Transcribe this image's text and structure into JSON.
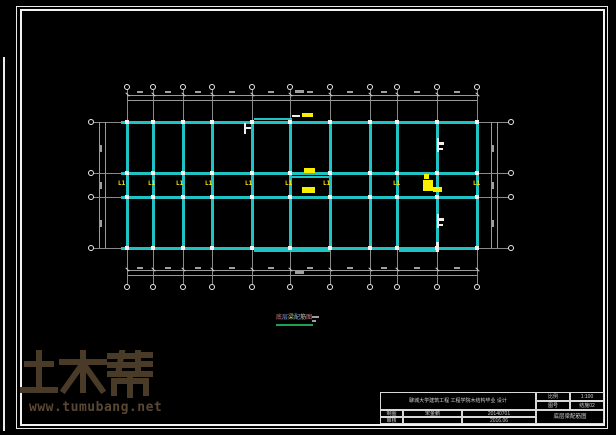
{
  "sheet": {
    "background": "#000000",
    "frame_color": "#f2f2f2"
  },
  "watermark": {
    "brand": "土木帮",
    "url": "www.tumubang.net",
    "logo_color": "#4a3a28",
    "url_color": "#5a4733"
  },
  "caption": {
    "chars": [
      {
        "ch": "底",
        "color": "#d08080"
      },
      {
        "ch": "层",
        "color": "#8098d8"
      },
      {
        "ch": "梁",
        "color": "#d0d080"
      },
      {
        "ch": "配",
        "color": "#80b8d8"
      },
      {
        "ch": "筋",
        "color": "#c8c8c8"
      },
      {
        "ch": "图",
        "color": "#d08080"
      }
    ],
    "underline_color": "#1ea050",
    "scale_marks": [
      {
        "x": 312,
        "y": 316,
        "w": 7,
        "h": 2
      },
      {
        "x": 312,
        "y": 320,
        "w": 4,
        "h": 2
      }
    ]
  },
  "title_block": {
    "project_title": "聊城大学建筑工程 工程学院木结构毕业 设计",
    "scale_label": "比例",
    "scale_value": "1:100",
    "sheet_no_label": "图号",
    "sheet_no_value": "结施02",
    "draw_label": "制图",
    "draw_name": "宋金鹏",
    "draw_no": "20140701",
    "check_label": "审核",
    "check_name": "",
    "check_date": "2016.06",
    "drawing_name": "底层梁配筋图"
  },
  "plan": {
    "beam_color": "#1fc3c3",
    "grid_color": "#8a8a8a",
    "tag_color": "#ffe800",
    "axes_x": [
      127,
      153,
      183,
      212,
      252,
      290,
      330,
      370,
      397,
      437,
      477
    ],
    "axes_y": [
      122,
      173,
      197,
      248
    ],
    "extent": {
      "x1": 121,
      "x2": 479,
      "y1": 121,
      "y2": 249
    },
    "grid": {
      "vy1": 90,
      "vy2": 284,
      "hx1": 94,
      "hx2": 508
    },
    "bubbles": {
      "top_y": 87,
      "bottom_y": 287,
      "left_x": 91,
      "right_x": 511
    },
    "dims": {
      "top": [
        95,
        100
      ],
      "bottom": [
        270,
        275
      ],
      "left": [
        99,
        105
      ],
      "right": [
        491,
        497
      ]
    },
    "tag_text": "L1",
    "tags_y": 180,
    "tags_x": [
      118,
      148,
      176,
      205,
      245,
      285,
      323,
      393,
      473
    ],
    "beam_segments": [
      {
        "x": 292,
        "y": 176,
        "w": 38,
        "h": 2
      },
      {
        "x": 254,
        "y": 250,
        "w": 76,
        "h": 2
      },
      {
        "x": 399,
        "y": 250,
        "w": 38,
        "h": 2
      },
      {
        "x": 254,
        "y": 118,
        "w": 38,
        "h": 2
      }
    ],
    "yellow_marks": [
      {
        "x": 302,
        "y": 113,
        "w": 11,
        "h": 4
      },
      {
        "x": 304,
        "y": 168,
        "w": 11,
        "h": 5
      },
      {
        "x": 302,
        "y": 187,
        "w": 13,
        "h": 6
      },
      {
        "x": 424,
        "y": 174,
        "w": 5,
        "h": 5
      },
      {
        "x": 423,
        "y": 180,
        "w": 10,
        "h": 11
      },
      {
        "x": 433,
        "y": 187,
        "w": 9,
        "h": 5
      }
    ],
    "white_marks": [
      {
        "x": 244,
        "y": 123,
        "w": 2,
        "h": 11
      },
      {
        "x": 246,
        "y": 127,
        "w": 5,
        "h": 2
      },
      {
        "x": 437,
        "y": 138,
        "w": 2,
        "h": 14
      },
      {
        "x": 439,
        "y": 142,
        "w": 5,
        "h": 3
      },
      {
        "x": 439,
        "y": 148,
        "w": 4,
        "h": 2
      },
      {
        "x": 437,
        "y": 214,
        "w": 2,
        "h": 14
      },
      {
        "x": 439,
        "y": 218,
        "w": 5,
        "h": 3
      },
      {
        "x": 439,
        "y": 224,
        "w": 4,
        "h": 2
      },
      {
        "x": 436,
        "y": 242,
        "w": 3,
        "h": 10
      },
      {
        "x": 292,
        "y": 115,
        "w": 8,
        "h": 2
      }
    ]
  }
}
